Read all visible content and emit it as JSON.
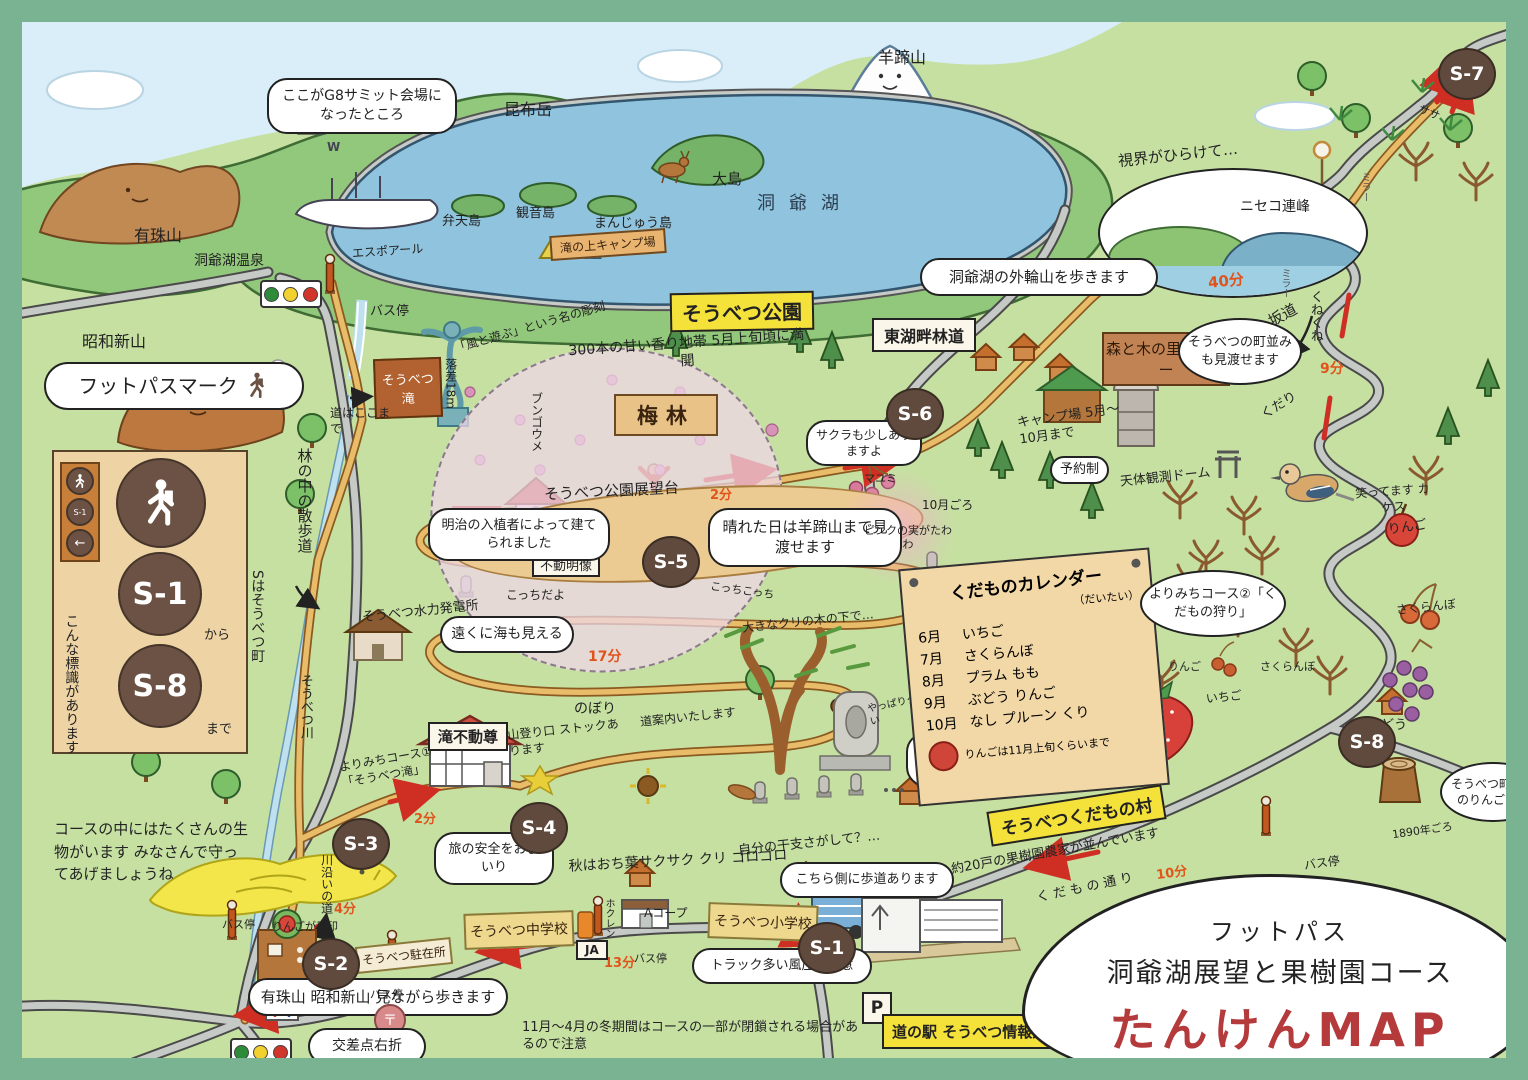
{
  "colors": {
    "frame": "#79b391",
    "course": "#e9bc6a",
    "road": "#c6cac6",
    "lake": "#8fc3de",
    "time_text": "#e0541c",
    "title_accent": "#b43a3c"
  },
  "title_cloud": {
    "kicker": "フットパス",
    "course": "洞爺湖展望と果樹園コース",
    "name": "たんけんMAP"
  },
  "legend": {
    "heading": "フットパスマーク",
    "s1": "S-1",
    "from": "から",
    "s8": "S-8",
    "to": "まで",
    "s_meaning": "Sはそうべつ町",
    "note": "こんな標識があります"
  },
  "stations": {
    "s1": "S-1",
    "s2": "S-2",
    "s3": "S-3",
    "s4": "S-4",
    "s5": "S-5",
    "s6": "S-6",
    "s7": "S-7",
    "s8": "S-8"
  },
  "times": {
    "park": "2分",
    "falls": "2分",
    "riverside": "4分",
    "slope": "9分",
    "orchard_street": "10分",
    "school_street": "13分",
    "switchback": "17分",
    "rim": "40分"
  },
  "north": {
    "g8": "ここがG8サミット会場になったところ",
    "w": "W",
    "konbudake": "昆布岳",
    "yoteizan": "羊蹄山",
    "lake": "洞爺湖",
    "oshima": "大島",
    "bentenjima": "弁天島",
    "kannonjima": "観音島",
    "manjujima": "まんじゅう島",
    "ship": "エスポアール",
    "camp_sign": "滝の上キャンプ場",
    "bus_stop": "バス停",
    "usuzan": "有珠山",
    "onsen": "洞爺湖温泉",
    "showa_shinzan": "昭和新山"
  },
  "west": {
    "falls_sign": "そうべつ滝",
    "drop": "落差18m",
    "road_end": "道はここまで",
    "sculpture": "「風と遊ぶ」という名の彫刻",
    "forest_path": "林の中の散歩道",
    "river": "そうべつ川",
    "wildlife": "コースの中にはたくさんの生物がいます みなさんで守ってあげましょうね",
    "power_plant": "そうべつ水力発電所",
    "sea_view": "遠くに海も見える",
    "side_course1": "よりみちコース①「そうべつ滝」",
    "river_road": "川沿いの道"
  },
  "park": {
    "sign": "そうべつ公園",
    "plum_note": "300本の甘い香り地帯 5月上旬頃に満開",
    "plum_sign": "梅林",
    "bungo_ume": "ブンゴウメ",
    "observatory": "そうべつ公園展望台",
    "meiji": "明治の入植者によって建てられました",
    "fudo": "不動明像",
    "clear_day": "晴れた日は羊蹄山まで見渡せます",
    "sakura": "サクラも少しありますよ",
    "mayumi": "マユミ",
    "mayumi_month": "10月ごろ",
    "mayumi_note": "ピンクの実がたわわ",
    "kocchi1": "こっちだよ",
    "kocchi2": "こっちこっち",
    "uphill": "のぼり",
    "trailhead": "山登り口 ストックあります",
    "guide": "道案内いたします",
    "chestnut": "大きなクリの木の下で…",
    "chestnut_pick": "やっぱりクリひろい",
    "doji": "三十六童子",
    "taki_fudoson": "滝不動尊",
    "autumn": "秋はおち葉サクサク クリ ゴロゴロ",
    "pray": "旅の安全をおまいり",
    "zodiac": "自分の干支さがして？…"
  },
  "east": {
    "rim_walk": "洞爺湖の外輪山を歩きます",
    "rindo_sign": "東湖畔林道",
    "view_opens": "視界がひらけて…",
    "niseko": "ニセコ連峰",
    "mori_sign": "森と木の里センター",
    "camp": "キャンプ場 5月～10月まで",
    "reserve": "予約制",
    "dome": "天体観測ドーム",
    "townscape": "そうべつの町並みも見渡せます",
    "mirror": "ミラー",
    "sasa": "ササ",
    "winding": "くねくね",
    "slope": "坂道",
    "downhill": "くだり",
    "jay": "笑ってます カケス"
  },
  "orchard": {
    "calendar": {
      "title": "くだものカレンダー",
      "sub": "（だいたい）",
      "rows": [
        {
          "m": "6月",
          "f": "いちご"
        },
        {
          "m": "7月",
          "f": "さくらんぼ"
        },
        {
          "m": "8月",
          "f": "プラム もも"
        },
        {
          "m": "9月",
          "f": "ぶどう りんご"
        },
        {
          "m": "10月",
          "f": "なし プルーン くり"
        }
      ],
      "note": "りんごは11月上旬くらいまで"
    },
    "side_course2": "よりみちコース②「くだもの狩り」",
    "apple": "りんご",
    "cherry": "さくらんぼ",
    "grape": "ぶどう",
    "strawberry": "いちご",
    "apple_small": "りんご",
    "cherry_small": "さくらんぼ",
    "village_sign": "そうべつくだもの村",
    "farms": "約20戸の果樹園農家が並んでいます",
    "street": "くだもの通り",
    "old_tree": "そうべつ町最古のりんごの木",
    "old_tree_year": "1890年ごろ",
    "bus_stop": "バス停"
  },
  "south": {
    "sidewalk": "こちら側に歩道あります",
    "trucks": "トラック多い風圧に注意",
    "michinoeki": "道の駅 そうべつ情報館ｉ",
    "parking": "P",
    "junior_high": "そうべつ中学校",
    "ja": "JA",
    "hokuren": "ホクレン",
    "acoop": "Aコープ",
    "bus_stop_school": "バス停",
    "elementary": "そうべつ小学校",
    "walk_view": "有珠山 昭和新山 見ながら歩きます",
    "winter": "11月～4月の冬期間はコースの一部が閉鎖される場合があるので注意",
    "police": "そうべつ駐在所",
    "post": "〒",
    "crossing": "交差点右折",
    "apple_landmark": "りんごが目印",
    "bus_stop_west": "バス停",
    "bus_stop_east": "バス停"
  }
}
